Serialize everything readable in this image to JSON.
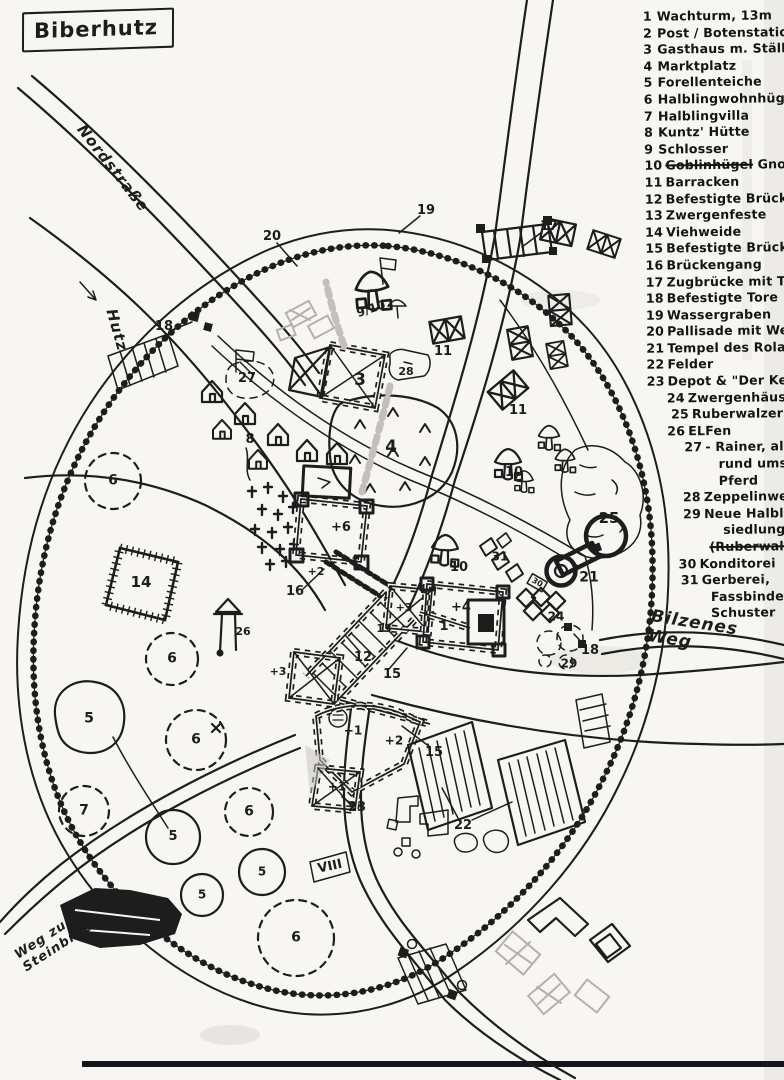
{
  "title": "Biberhutz",
  "colors": {
    "ink": "#1d1d1d",
    "paper": "#f7f6f2",
    "pencil": "#b4b1aa"
  },
  "legend": {
    "items": [
      {
        "num": "1",
        "indent": 0,
        "lines": [
          [
            {
              "t": "Wachturm, 13m"
            }
          ]
        ]
      },
      {
        "num": "2",
        "indent": 0,
        "lines": [
          [
            {
              "t": "Post / Botenstation"
            }
          ]
        ]
      },
      {
        "num": "3",
        "indent": 0,
        "lines": [
          [
            {
              "t": "Gasthaus m. Ställen"
            }
          ]
        ]
      },
      {
        "num": "4",
        "indent": 0,
        "lines": [
          [
            {
              "t": "Marktplatz"
            }
          ]
        ]
      },
      {
        "num": "5",
        "indent": 0,
        "lines": [
          [
            {
              "t": "Forellenteiche"
            }
          ]
        ]
      },
      {
        "num": "6",
        "indent": 0,
        "lines": [
          [
            {
              "t": "Halblingwohnhügel"
            }
          ]
        ]
      },
      {
        "num": "7",
        "indent": 0,
        "lines": [
          [
            {
              "t": "Halblingvilla"
            }
          ]
        ]
      },
      {
        "num": "8",
        "indent": 0,
        "lines": [
          [
            {
              "t": "Kuntz' Hütte"
            }
          ]
        ]
      },
      {
        "num": "9",
        "indent": 0,
        "lines": [
          [
            {
              "t": "Schlosser"
            }
          ]
        ]
      },
      {
        "num": "10",
        "indent": 0,
        "lines": [
          [
            {
              "t": "Goblinhügel",
              "s": true
            },
            {
              "t": " Gnompilze"
            }
          ]
        ]
      },
      {
        "num": "11",
        "indent": 0,
        "lines": [
          [
            {
              "t": "Barracken"
            }
          ]
        ]
      },
      {
        "num": "12",
        "indent": 0,
        "lines": [
          [
            {
              "t": "Befestigte Brücke"
            }
          ]
        ]
      },
      {
        "num": "13",
        "indent": 0,
        "lines": [
          [
            {
              "t": "Zwergenfeste"
            }
          ]
        ]
      },
      {
        "num": "14",
        "indent": 0,
        "lines": [
          [
            {
              "t": "Viehweide"
            }
          ]
        ]
      },
      {
        "num": "15",
        "indent": 0,
        "lines": [
          [
            {
              "t": "Befestigte Brückenhäuser"
            }
          ]
        ]
      },
      {
        "num": "16",
        "indent": 0,
        "lines": [
          [
            {
              "t": "Brückengang"
            }
          ]
        ]
      },
      {
        "num": "17",
        "indent": 0,
        "lines": [
          [
            {
              "t": "Zugbrücke mit Türmen"
            }
          ]
        ]
      },
      {
        "num": "18",
        "indent": 0,
        "lines": [
          [
            {
              "t": "Befestigte Tore"
            }
          ]
        ]
      },
      {
        "num": "19",
        "indent": 0,
        "lines": [
          [
            {
              "t": "Wassergraben"
            }
          ]
        ]
      },
      {
        "num": "20",
        "indent": 0,
        "lines": [
          [
            {
              "t": "Pallisade mit Wehrgängen"
            }
          ]
        ]
      },
      {
        "num": "21",
        "indent": 0,
        "lines": [
          [
            {
              "t": "Tempel des Roland"
            }
          ]
        ]
      },
      {
        "num": "22",
        "indent": 0,
        "lines": [
          [
            {
              "t": "Felder"
            }
          ]
        ]
      },
      {
        "num": "23",
        "indent": 0,
        "lines": [
          [
            {
              "t": "Depot & \"Der Keller\""
            }
          ]
        ]
      },
      {
        "num": "24",
        "indent": 20,
        "lines": [
          [
            {
              "t": "Zwergenhäuser"
            }
          ]
        ]
      },
      {
        "num": "25",
        "indent": 24,
        "lines": [
          [
            {
              "t": "Ruberwalzer"
            }
          ]
        ]
      },
      {
        "num": "26",
        "indent": 20,
        "lines": [
          [
            {
              "t": "ELFen"
            }
          ]
        ]
      },
      {
        "num": "27",
        "indent": 37,
        "lines": [
          [
            {
              "t": "- Rainer, alles"
            }
          ],
          [
            {
              "t": "rund ums",
              "ind": 20
            }
          ],
          [
            {
              "t": "Pferd",
              "ind": 20
            }
          ]
        ]
      },
      {
        "num": "28",
        "indent": 35,
        "lines": [
          [
            {
              "t": "Zeppelinwerft"
            }
          ]
        ]
      },
      {
        "num": "29",
        "indent": 35,
        "lines": [
          [
            {
              "t": "Neue Halbling-"
            }
          ],
          [
            {
              "t": "siedlung",
              "ind": 26
            }
          ],
          [
            {
              "t": "(Ruberwalzer)",
              "s": true,
              "ind": 12
            }
          ]
        ]
      },
      {
        "num": "30",
        "indent": 30,
        "lines": [
          [
            {
              "t": "Konditorei"
            }
          ]
        ]
      },
      {
        "num": "31",
        "indent": 32,
        "lines": [
          [
            {
              "t": "Gerberei,"
            }
          ],
          [
            {
              "t": "Fassbinderei,",
              "ind": 16
            }
          ],
          [
            {
              "t": "Schuster",
              "ind": 16
            }
          ]
        ]
      }
    ]
  },
  "map": {
    "road_labels": [
      {
        "text": "Nordstraße",
        "x": 113,
        "y": 168,
        "rot": 52,
        "fs": 15
      },
      {
        "text": "Hutz",
        "x": 117,
        "y": 330,
        "rot": 74,
        "fs": 15
      },
      {
        "text": "Bilzenes Weg",
        "x": 694,
        "y": 633,
        "rot": 9,
        "fs": 17
      },
      {
        "text": "Weg zum\nSteinbruch",
        "x": 58,
        "y": 938,
        "rot": -33,
        "fs": 13
      }
    ],
    "markers": [
      {
        "t": "17",
        "x": 549,
        "y": 227
      },
      {
        "t": "19",
        "x": 426,
        "y": 211
      },
      {
        "t": "20",
        "x": 272,
        "y": 237
      },
      {
        "t": "18",
        "x": 164,
        "y": 327
      },
      {
        "t": "27",
        "x": 247,
        "y": 379,
        "fs": 13
      },
      {
        "t": "3",
        "x": 360,
        "y": 381,
        "fs": 17
      },
      {
        "t": "9/10",
        "x": 371,
        "y": 309,
        "rot": -18,
        "fs": 12
      },
      {
        "t": "28",
        "x": 406,
        "y": 372,
        "fs": 11
      },
      {
        "t": "11",
        "x": 443,
        "y": 352
      },
      {
        "t": "11",
        "x": 518,
        "y": 411
      },
      {
        "t": "4",
        "x": 391,
        "y": 448,
        "fs": 17
      },
      {
        "t": "8",
        "x": 250,
        "y": 440
      },
      {
        "t": "10",
        "x": 514,
        "y": 473,
        "fs": 13
      },
      {
        "t": "10",
        "x": 459,
        "y": 568,
        "fs": 13
      },
      {
        "t": "25",
        "x": 609,
        "y": 519,
        "fs": 15
      },
      {
        "t": "21",
        "x": 589,
        "y": 578,
        "fs": 14
      },
      {
        "t": "31",
        "x": 500,
        "y": 557,
        "fs": 12
      },
      {
        "t": "30",
        "x": 537,
        "y": 583,
        "rot": 30,
        "fs": 8
      },
      {
        "t": "24",
        "x": 556,
        "y": 617,
        "fs": 12
      },
      {
        "t": "29",
        "x": 569,
        "y": 664,
        "fs": 12
      },
      {
        "t": "18",
        "x": 590,
        "y": 651
      },
      {
        "t": "+6",
        "x": 341,
        "y": 528,
        "fs": 13
      },
      {
        "t": "+2",
        "x": 316,
        "y": 572,
        "fs": 11
      },
      {
        "t": "16",
        "x": 295,
        "y": 592
      },
      {
        "t": "12",
        "x": 363,
        "y": 658
      },
      {
        "t": "15",
        "x": 392,
        "y": 675
      },
      {
        "t": "15",
        "x": 434,
        "y": 753
      },
      {
        "t": "13",
        "x": 384,
        "y": 629,
        "fs": 11
      },
      {
        "t": "+3",
        "x": 404,
        "y": 608,
        "fs": 11
      },
      {
        "t": "+3",
        "x": 278,
        "y": 672,
        "fs": 11
      },
      {
        "t": "1",
        "x": 444,
        "y": 627,
        "fs": 13
      },
      {
        "t": "+4",
        "x": 461,
        "y": 608,
        "fs": 13
      },
      {
        "t": "+1",
        "x": 353,
        "y": 731,
        "fs": 12
      },
      {
        "t": "+2",
        "x": 394,
        "y": 741,
        "fs": 12
      },
      {
        "t": "+1",
        "x": 337,
        "y": 787,
        "fs": 12
      },
      {
        "t": "23",
        "x": 357,
        "y": 808
      },
      {
        "t": "22",
        "x": 463,
        "y": 826
      },
      {
        "t": "VIII",
        "x": 330,
        "y": 867,
        "rot": -12,
        "fs": 13
      },
      {
        "t": "14",
        "x": 141,
        "y": 583,
        "fs": 15
      },
      {
        "t": "26",
        "x": 243,
        "y": 632,
        "fs": 11
      },
      {
        "t": "6",
        "x": 113,
        "y": 481,
        "fs": 14
      },
      {
        "t": "6",
        "x": 172,
        "y": 659,
        "fs": 14
      },
      {
        "t": "6",
        "x": 196,
        "y": 740,
        "fs": 14
      },
      {
        "t": "6",
        "x": 249,
        "y": 812,
        "fs": 14
      },
      {
        "t": "7",
        "x": 84,
        "y": 811,
        "fs": 14
      },
      {
        "t": "6",
        "x": 296,
        "y": 938,
        "fs": 14
      },
      {
        "t": "5",
        "x": 89,
        "y": 719,
        "fs": 14
      },
      {
        "t": "5",
        "x": 173,
        "y": 837,
        "fs": 13
      },
      {
        "t": "5",
        "x": 202,
        "y": 895,
        "fs": 12
      },
      {
        "t": "5",
        "x": 262,
        "y": 872,
        "fs": 12
      }
    ]
  }
}
